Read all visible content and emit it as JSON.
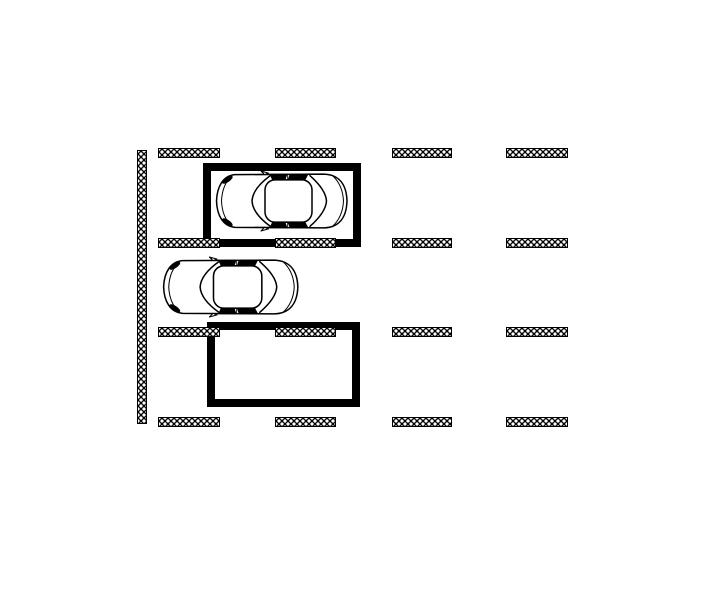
{
  "page": {
    "background_color": "#ffffff",
    "line_color": "#000000",
    "description": "Parking layout plan drawing: hatched wall strip, grid of hatched stall marker ticks, two bold stall outlines, two top-view cars facing left"
  },
  "diagram": {
    "wall_hatch": {
      "x": 137,
      "y": 150,
      "width": 10,
      "height": 274
    },
    "tick_grid": {
      "tick_height": 10,
      "rows": [
        {
          "y": 148
        },
        {
          "y": 238
        },
        {
          "y": 327
        },
        {
          "y": 417
        }
      ],
      "cols": [
        {
          "x": 158,
          "w": 62
        },
        {
          "x": 275,
          "w": 61
        },
        {
          "x": 392,
          "w": 60
        },
        {
          "x": 506,
          "w": 62
        }
      ]
    },
    "stalls": [
      {
        "id": "parking-stall-occupied",
        "x": 203,
        "y": 163,
        "width": 158,
        "height": 84,
        "border": 8,
        "occupied": true
      },
      {
        "id": "parking-stall-empty",
        "x": 207,
        "y": 322,
        "width": 153,
        "height": 85,
        "border": 8,
        "occupied": false
      }
    ],
    "cars": [
      {
        "id": "car-parked-in-stall",
        "x": 213,
        "y": 170,
        "width": 140,
        "height": 62,
        "facing": "left"
      },
      {
        "id": "car-in-aisle",
        "x": 160,
        "y": 256,
        "width": 144,
        "height": 62,
        "facing": "left"
      }
    ]
  }
}
